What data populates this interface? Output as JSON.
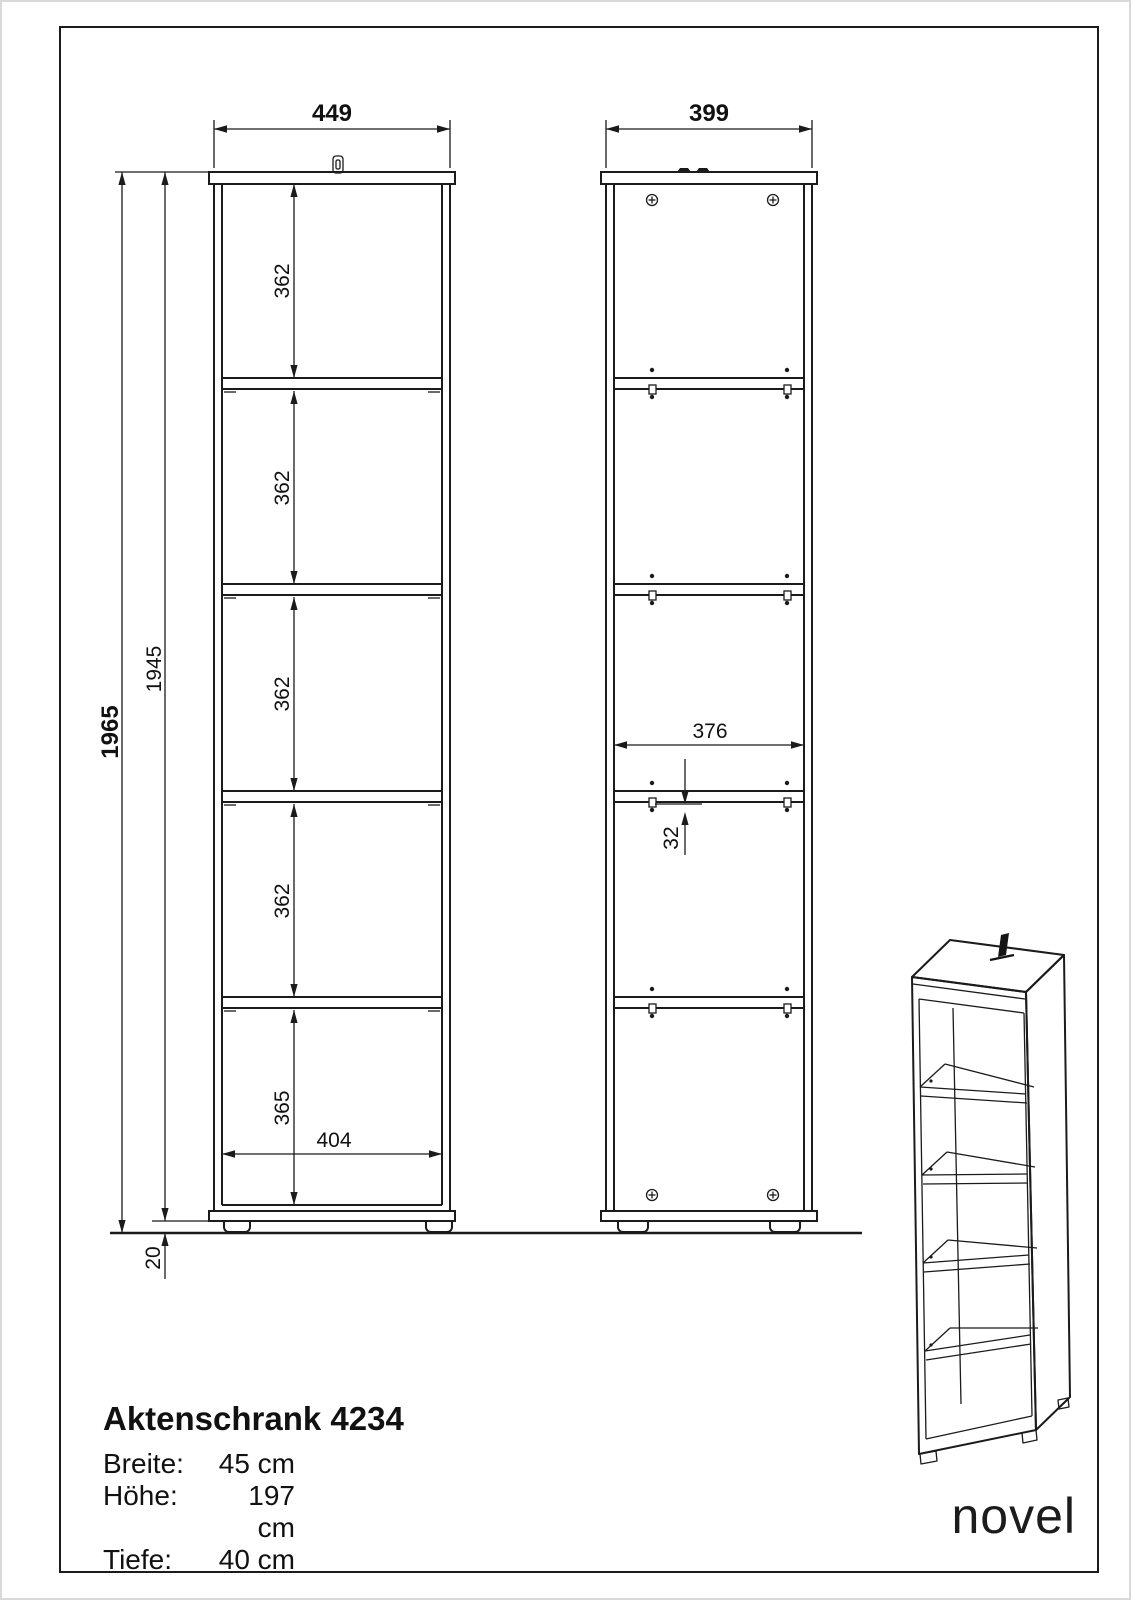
{
  "front_view": {
    "width": "449",
    "compartments": [
      "362",
      "362",
      "362",
      "362",
      "365"
    ],
    "inner_width": "404",
    "total_height": "1965",
    "body_height": "1945",
    "foot_height": "20"
  },
  "back_view": {
    "width": "399",
    "inner_width": "376",
    "hole_pitch": "32"
  },
  "title_block": {
    "title": "Aktenschrank 4234",
    "specs": [
      {
        "label": "Breite:",
        "value": "45 cm"
      },
      {
        "label": "Höhe:",
        "value": "197 cm"
      },
      {
        "label": "Tiefe:",
        "value": "40 cm"
      }
    ]
  },
  "brand": {
    "logo": "novel"
  }
}
